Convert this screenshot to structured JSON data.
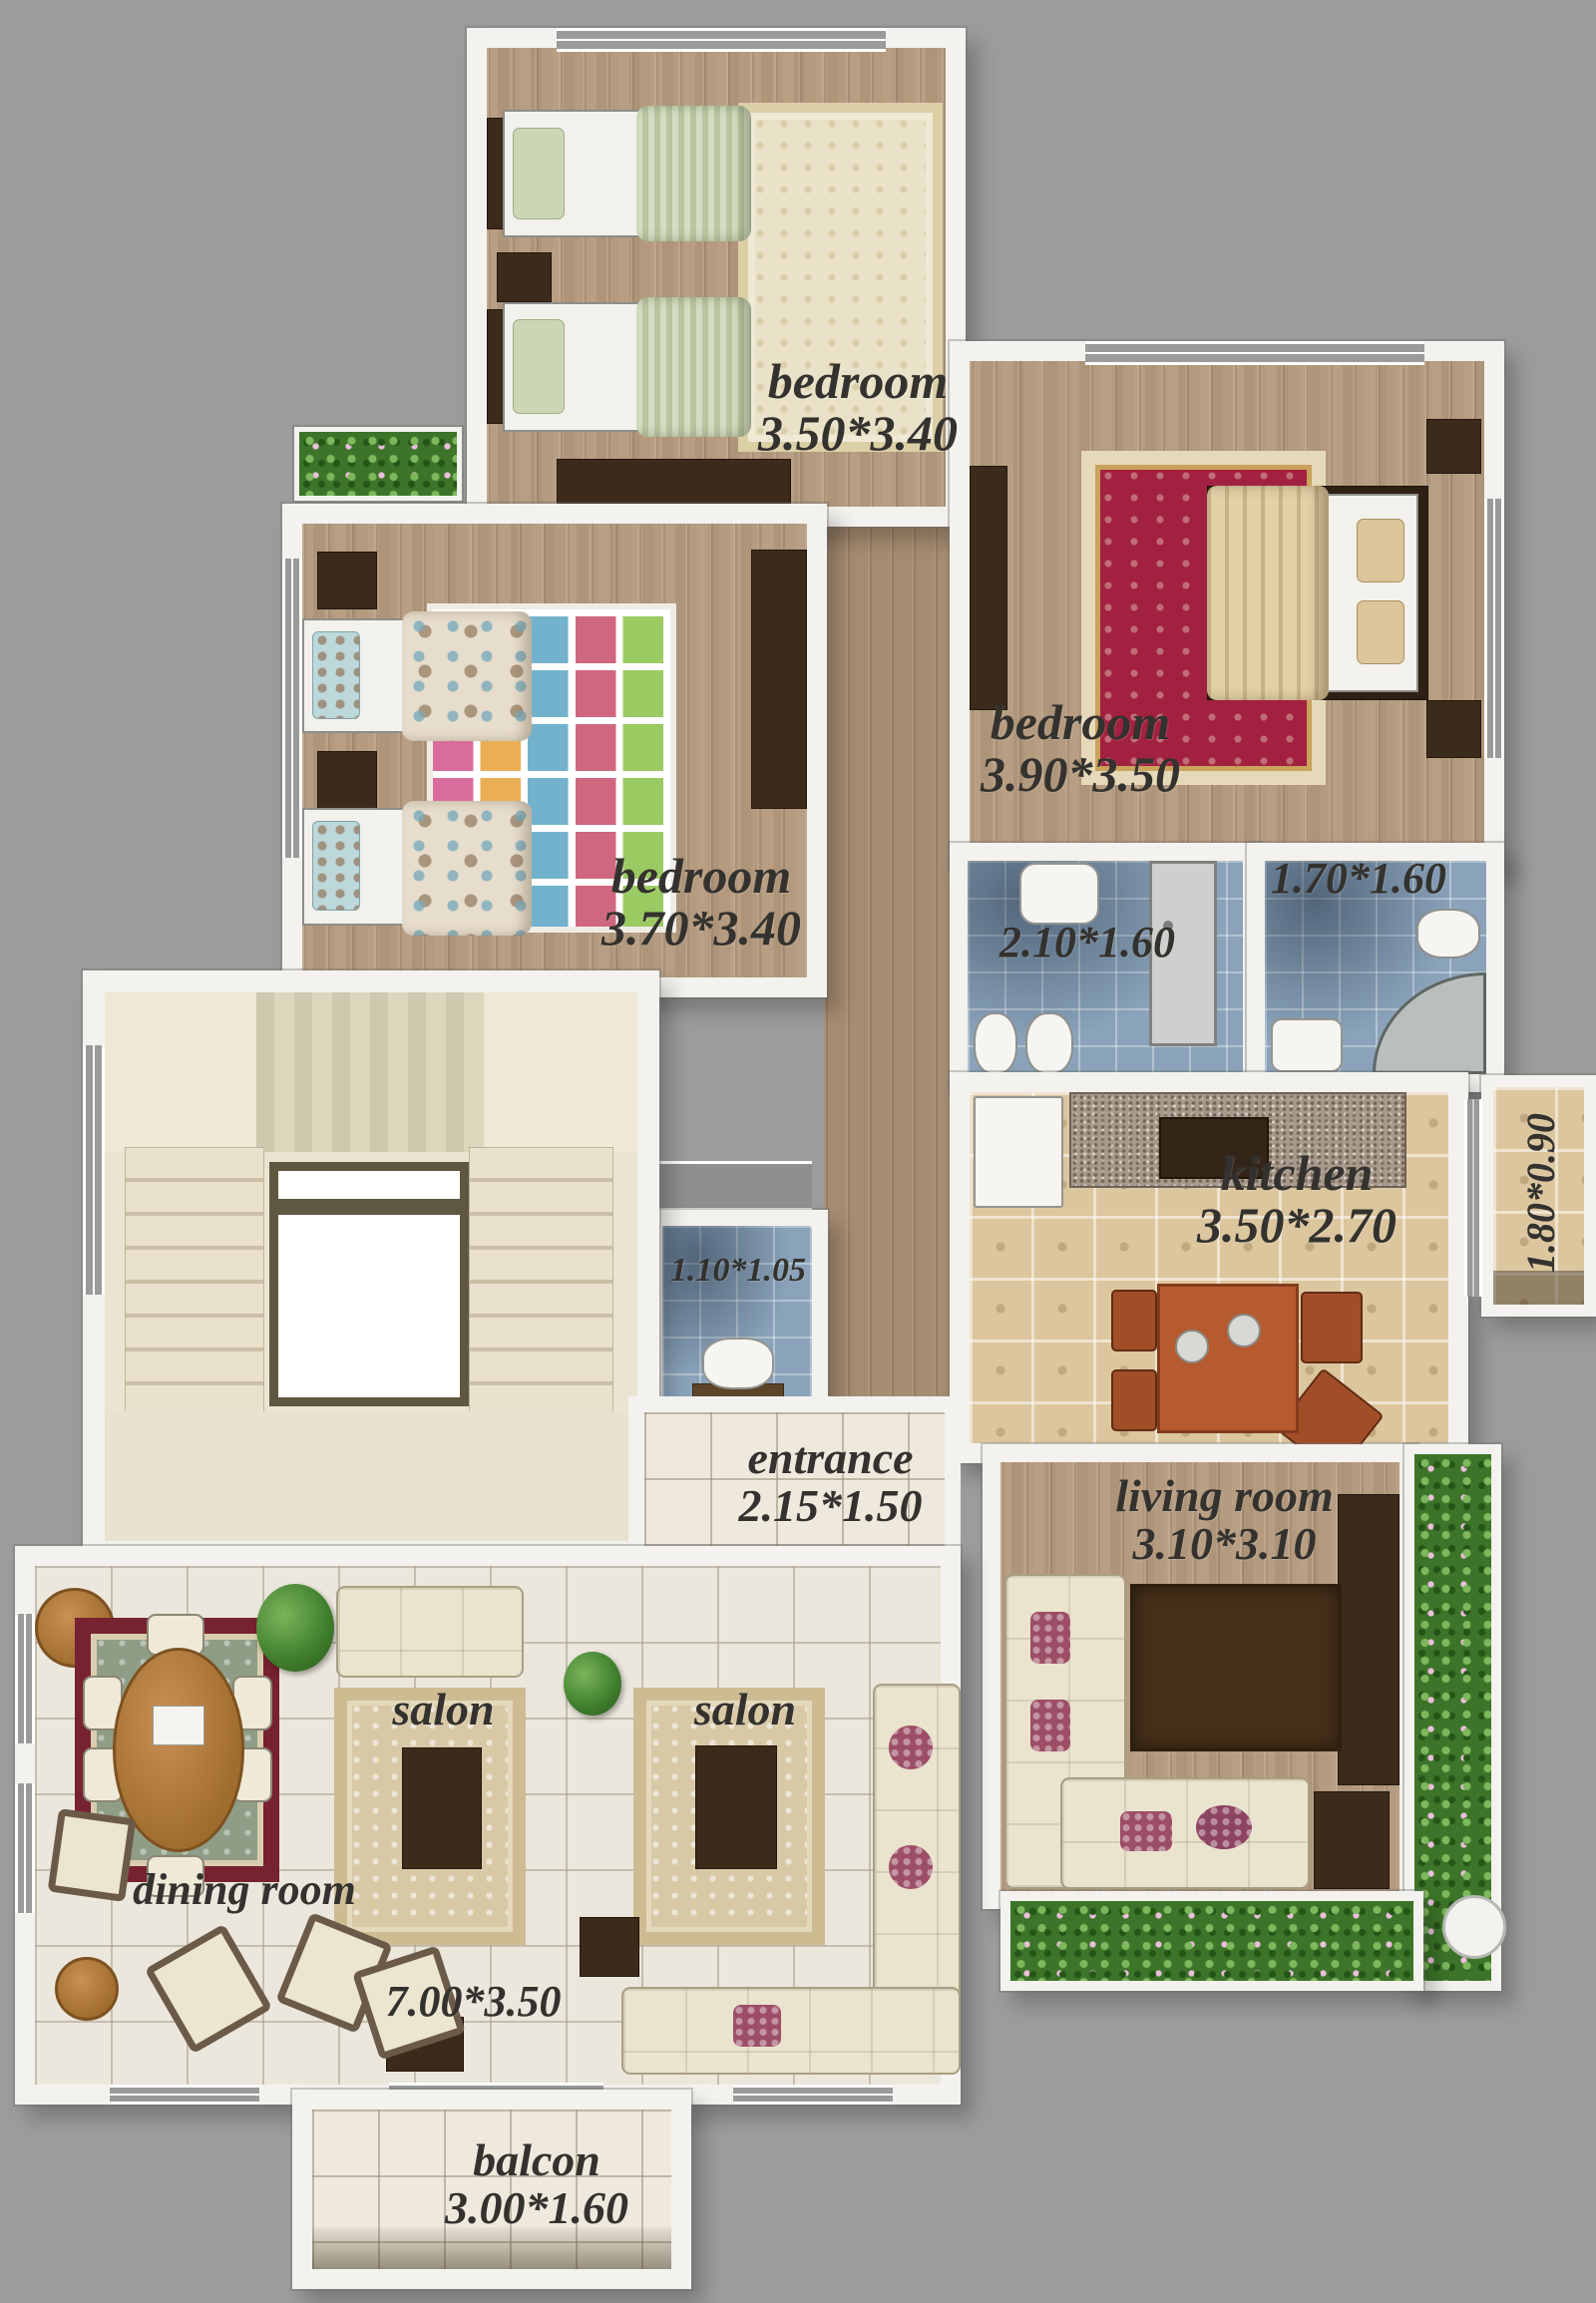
{
  "title": "apartment floor plan",
  "colors": {
    "background": "#9c9c9c",
    "wall": "#f3f2ee",
    "wood_floor": "#b29878",
    "salon_tile": "#ece7dd",
    "kitchen_tile": "#dcc69e",
    "bath_tile": "#8aa3ba",
    "label_text": "#34322e",
    "plant_green": "#3c7429",
    "rug_red": "#a22040",
    "dark_wood": "#3c2a1b"
  },
  "rooms": [
    {
      "id": "bedroom-top",
      "name": "bedroom",
      "dims": "3.50*3.40"
    },
    {
      "id": "bedroom-right",
      "name": "bedroom",
      "dims": "3.90*3.50"
    },
    {
      "id": "bedroom-left",
      "name": "bedroom",
      "dims": "3.70*3.40"
    },
    {
      "id": "bathroom-main",
      "name": "",
      "dims": "2.10*1.60"
    },
    {
      "id": "bathroom-corner",
      "name": "",
      "dims": "1.70*1.60"
    },
    {
      "id": "kitchen",
      "name": "kitchen",
      "dims": "3.50*2.70"
    },
    {
      "id": "kitchen-balcony",
      "name": "",
      "dims": "1.80*0.90"
    },
    {
      "id": "wc",
      "name": "",
      "dims": "1.10*1.05"
    },
    {
      "id": "entrance",
      "name": "entrance",
      "dims": "2.15*1.50"
    },
    {
      "id": "living-room",
      "name": "living room",
      "dims": "3.10*3.10"
    },
    {
      "id": "salon-left",
      "name": "salon",
      "dims": ""
    },
    {
      "id": "salon-right",
      "name": "salon",
      "dims": ""
    },
    {
      "id": "dining-room",
      "name": "dining room",
      "dims": ""
    },
    {
      "id": "salon-size",
      "name": "",
      "dims": "7.00*3.50"
    },
    {
      "id": "balcony",
      "name": "balcon",
      "dims": "3.00*1.60"
    }
  ]
}
